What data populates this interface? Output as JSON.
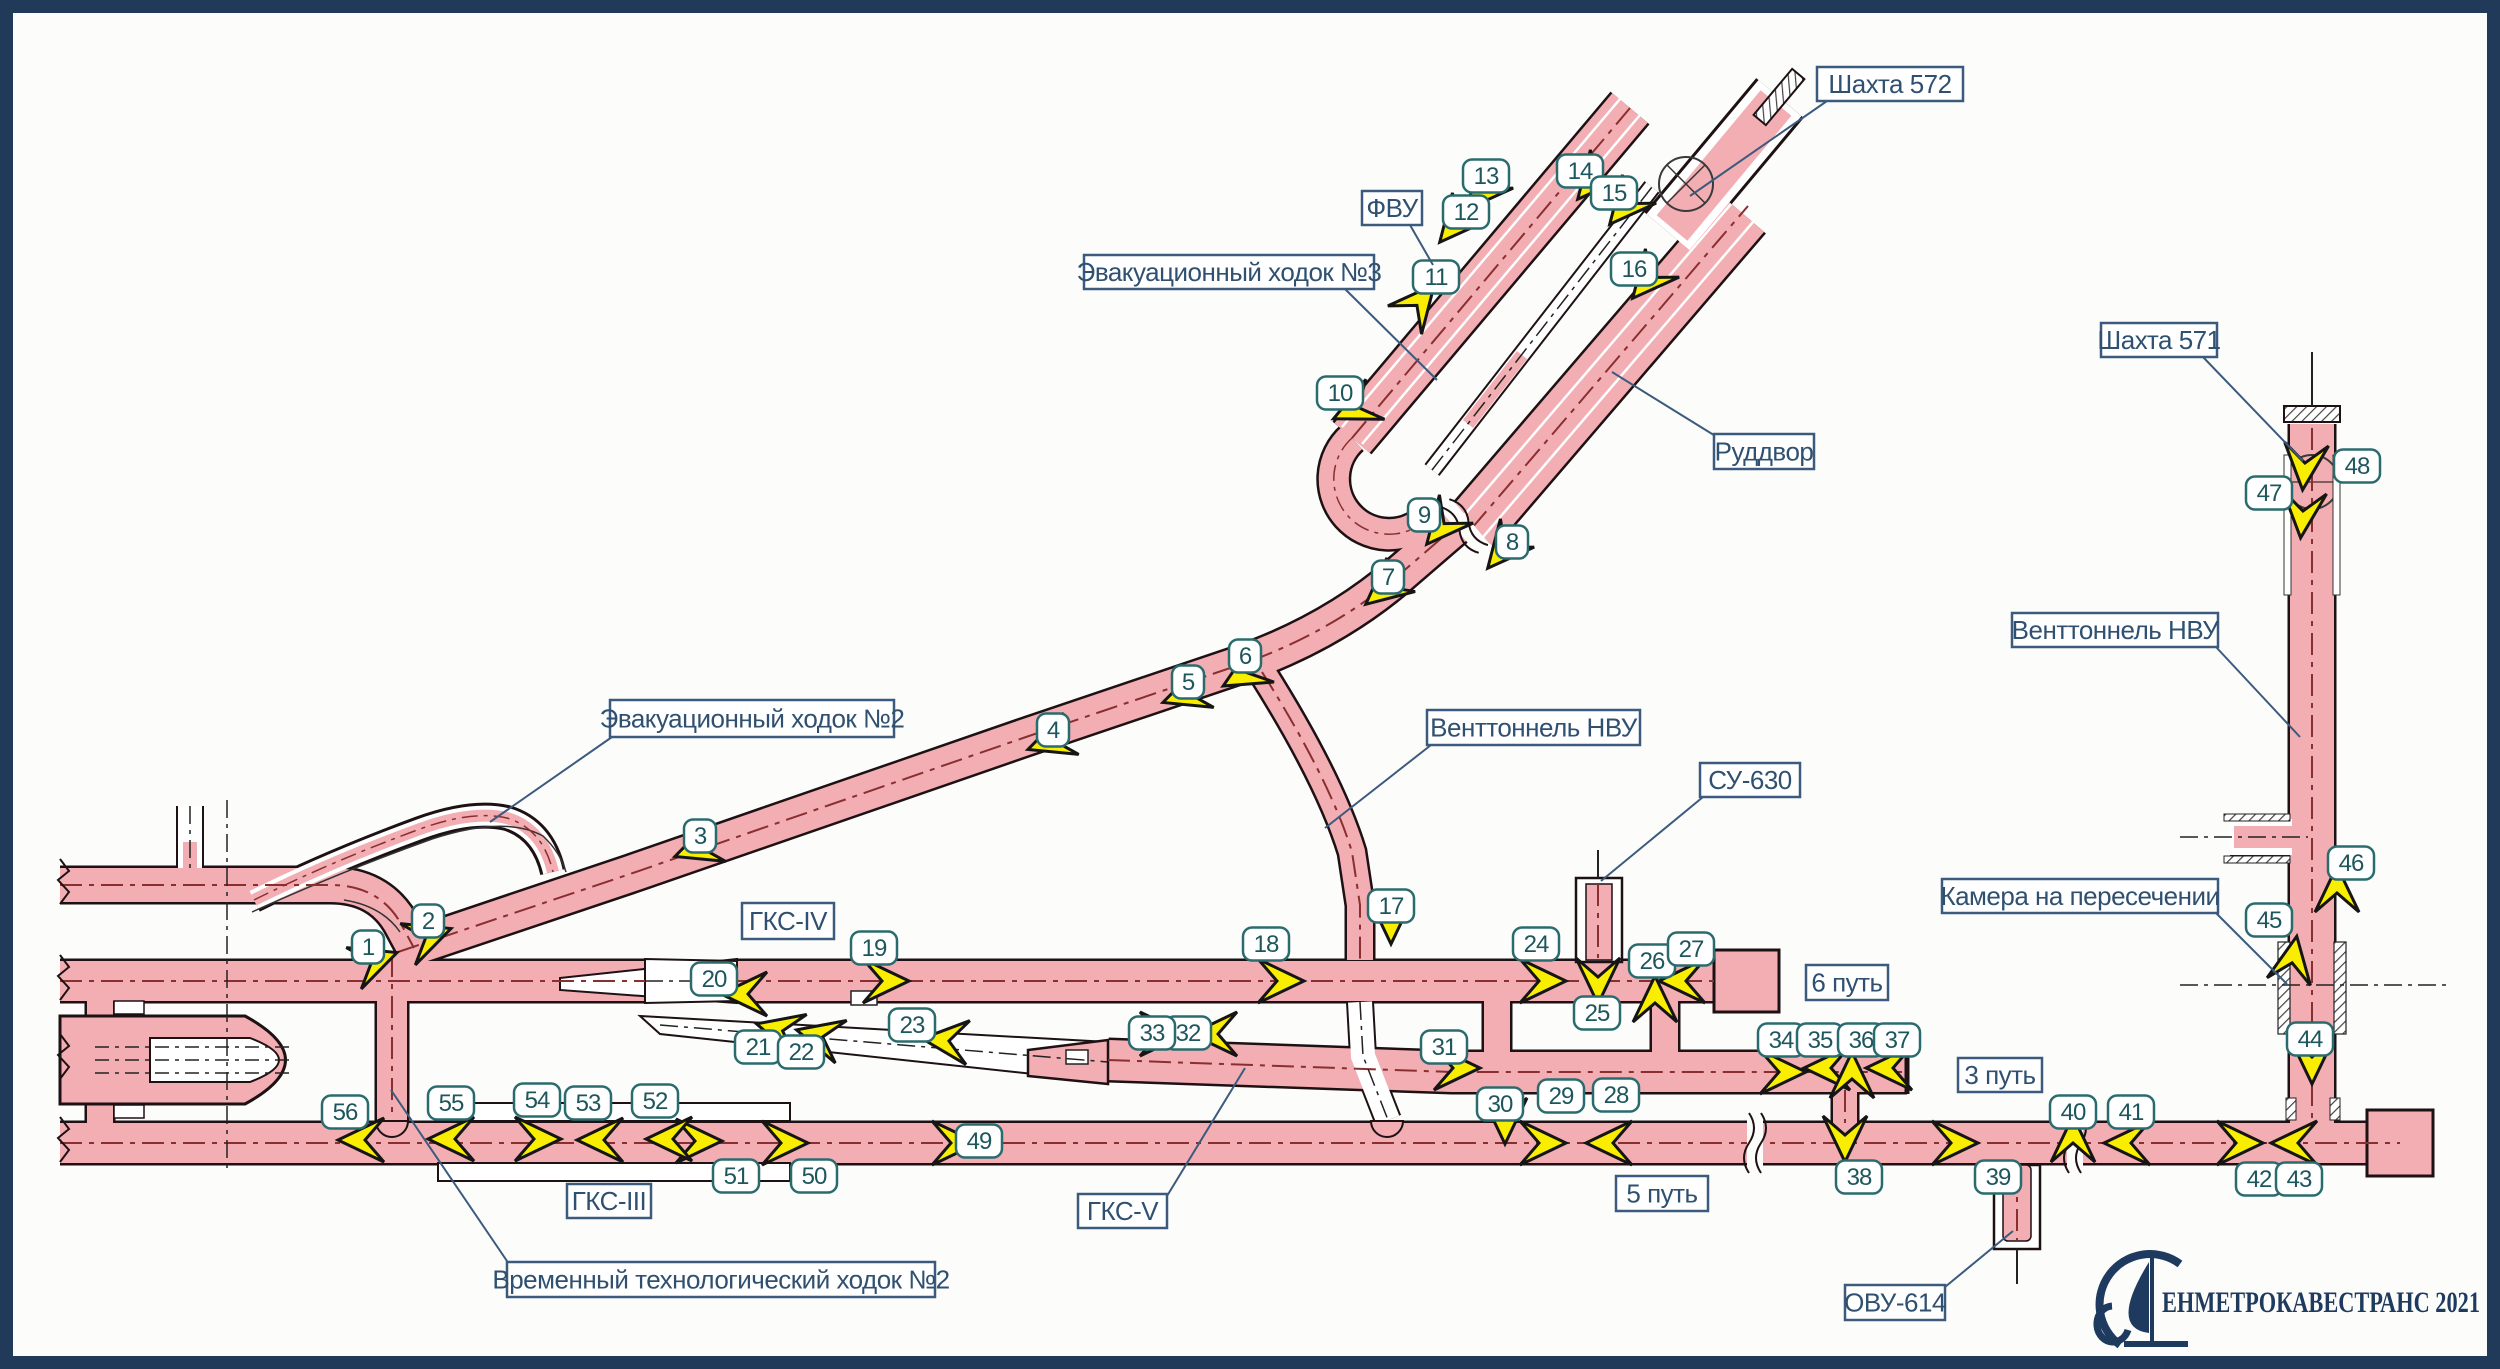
{
  "diagram": {
    "title_note": "tunnel construction scheme",
    "colors": {
      "paper": "#fcfcfb",
      "frame": "#223a5a",
      "tunnel_fill": "#f2aeb3",
      "tunnel_outline": "#1d1114",
      "tunnel_axis": "#8a2f2f",
      "unbuilt_fill": "#ffffff",
      "arrow_fill": "#f9ee00",
      "arrow_outline": "#151515",
      "marker_border": "#2a6b6e",
      "marker_text": "#1d565c",
      "label_border": "#3b5a7d",
      "label_text": "#2f5070",
      "logo": "#1e3a5e"
    },
    "labels": [
      {
        "id": "shaft-572",
        "text": "Шахта 572",
        "x": 1817,
        "y": 67,
        "w": 146,
        "h": 34,
        "leader": [
          [
            1827,
            101
          ],
          [
            1690,
            196
          ]
        ]
      },
      {
        "id": "fvu",
        "text": "ФВУ",
        "x": 1362,
        "y": 191,
        "w": 60,
        "h": 34,
        "leader": [
          [
            1410,
            225
          ],
          [
            1433,
            265
          ]
        ]
      },
      {
        "id": "evac-walk-3",
        "text": "Эвакуационный ходок №3",
        "x": 1084,
        "y": 255,
        "w": 290,
        "h": 34,
        "leader": [
          [
            1345,
            289
          ],
          [
            1437,
            380
          ]
        ]
      },
      {
        "id": "ruddvor",
        "text": "Руддвор",
        "x": 1714,
        "y": 434,
        "w": 100,
        "h": 35,
        "leader": [
          [
            1717,
            437
          ],
          [
            1612,
            372
          ]
        ]
      },
      {
        "id": "shaft-571",
        "text": "Шахта 571",
        "x": 2101,
        "y": 323,
        "w": 116,
        "h": 34,
        "leader": [
          [
            2203,
            357
          ],
          [
            2303,
            461
          ]
        ]
      },
      {
        "id": "vent-nvu-right",
        "text": "Венттоннель НВУ",
        "x": 2012,
        "y": 613,
        "w": 206,
        "h": 34,
        "leader": [
          [
            2216,
            647
          ],
          [
            2300,
            737
          ]
        ]
      },
      {
        "id": "vent-nvu-mid",
        "text": "Венттоннель НВУ",
        "x": 1427,
        "y": 710,
        "w": 213,
        "h": 35,
        "leader": [
          [
            1431,
            745
          ],
          [
            1325,
            828
          ]
        ]
      },
      {
        "id": "su-630",
        "text": "СУ-630",
        "x": 1700,
        "y": 763,
        "w": 100,
        "h": 34,
        "leader": [
          [
            1703,
            797
          ],
          [
            1601,
            881
          ]
        ]
      },
      {
        "id": "chamber",
        "text": "Камера на пересечении",
        "x": 1942,
        "y": 879,
        "w": 276,
        "h": 34,
        "leader": [
          [
            2216,
            913
          ],
          [
            2287,
            984
          ]
        ]
      },
      {
        "id": "gks-4",
        "text": "ГКС-IV",
        "x": 742,
        "y": 903,
        "w": 92,
        "h": 36,
        "leader": null
      },
      {
        "id": "track-6",
        "text": "6 путь",
        "x": 1806,
        "y": 965,
        "w": 82,
        "h": 35,
        "leader": null
      },
      {
        "id": "track-3",
        "text": "3 путь",
        "x": 1958,
        "y": 1058,
        "w": 84,
        "h": 34,
        "leader": null
      },
      {
        "id": "track-5",
        "text": "5 путь",
        "x": 1616,
        "y": 1176,
        "w": 92,
        "h": 35,
        "leader": null
      },
      {
        "id": "gks-3",
        "text": "ГКС-III",
        "x": 567,
        "y": 1184,
        "w": 84,
        "h": 34,
        "leader": null
      },
      {
        "id": "gks-5",
        "text": "ГКС-V",
        "x": 1078,
        "y": 1194,
        "w": 89,
        "h": 34,
        "leader": [
          [
            1167,
            1196
          ],
          [
            1245,
            1068
          ]
        ]
      },
      {
        "id": "ovu-614",
        "text": "ОВУ-614",
        "x": 1845,
        "y": 1285,
        "w": 100,
        "h": 35,
        "leader": [
          [
            1945,
            1287
          ],
          [
            2013,
            1231
          ]
        ]
      },
      {
        "id": "evac-walk-2",
        "text": "Эвакуационный ходок №2",
        "x": 610,
        "y": 700,
        "w": 284,
        "h": 37,
        "leader": [
          [
            612,
            737
          ],
          [
            490,
            822
          ]
        ]
      },
      {
        "id": "temp-walk-2",
        "text": "Временный технологический ходок №2",
        "x": 507,
        "y": 1262,
        "w": 428,
        "h": 35,
        "leader": [
          [
            509,
            1264
          ],
          [
            391,
            1090
          ]
        ]
      }
    ],
    "markers": [
      {
        "n": "1",
        "x": 368,
        "y": 947
      },
      {
        "n": "2",
        "x": 428,
        "y": 921
      },
      {
        "n": "3",
        "x": 700,
        "y": 836
      },
      {
        "n": "4",
        "x": 1053,
        "y": 730
      },
      {
        "n": "5",
        "x": 1188,
        "y": 682
      },
      {
        "n": "6",
        "x": 1245,
        "y": 656
      },
      {
        "n": "7",
        "x": 1388,
        "y": 577
      },
      {
        "n": "8",
        "x": 1512,
        "y": 542
      },
      {
        "n": "9",
        "x": 1424,
        "y": 515
      },
      {
        "n": "10",
        "x": 1340,
        "y": 393
      },
      {
        "n": "11",
        "x": 1436,
        "y": 277
      },
      {
        "n": "12",
        "x": 1466,
        "y": 212
      },
      {
        "n": "13",
        "x": 1486,
        "y": 176
      },
      {
        "n": "14",
        "x": 1580,
        "y": 171
      },
      {
        "n": "15",
        "x": 1614,
        "y": 193
      },
      {
        "n": "16",
        "x": 1634,
        "y": 269
      },
      {
        "n": "17",
        "x": 1391,
        "y": 906
      },
      {
        "n": "18",
        "x": 1266,
        "y": 944
      },
      {
        "n": "19",
        "x": 874,
        "y": 948
      },
      {
        "n": "20",
        "x": 714,
        "y": 979
      },
      {
        "n": "21",
        "x": 758,
        "y": 1047
      },
      {
        "n": "22",
        "x": 801,
        "y": 1052
      },
      {
        "n": "23",
        "x": 912,
        "y": 1025
      },
      {
        "n": "24",
        "x": 1536,
        "y": 944
      },
      {
        "n": "25",
        "x": 1597,
        "y": 1013
      },
      {
        "n": "26",
        "x": 1652,
        "y": 961
      },
      {
        "n": "27",
        "x": 1691,
        "y": 949
      },
      {
        "n": "28",
        "x": 1616,
        "y": 1095
      },
      {
        "n": "29",
        "x": 1561,
        "y": 1096
      },
      {
        "n": "30",
        "x": 1500,
        "y": 1104
      },
      {
        "n": "31",
        "x": 1444,
        "y": 1047
      },
      {
        "n": "32",
        "x": 1188,
        "y": 1033
      },
      {
        "n": "33",
        "x": 1152,
        "y": 1033
      },
      {
        "n": "34",
        "x": 1781,
        "y": 1040
      },
      {
        "n": "35",
        "x": 1820,
        "y": 1040
      },
      {
        "n": "36",
        "x": 1861,
        "y": 1040
      },
      {
        "n": "37",
        "x": 1897,
        "y": 1040
      },
      {
        "n": "38",
        "x": 1859,
        "y": 1177
      },
      {
        "n": "39",
        "x": 1998,
        "y": 1177
      },
      {
        "n": "40",
        "x": 2073,
        "y": 1112
      },
      {
        "n": "41",
        "x": 2131,
        "y": 1112
      },
      {
        "n": "42",
        "x": 2259,
        "y": 1179
      },
      {
        "n": "43",
        "x": 2299,
        "y": 1179
      },
      {
        "n": "44",
        "x": 2310,
        "y": 1039
      },
      {
        "n": "45",
        "x": 2269,
        "y": 920
      },
      {
        "n": "46",
        "x": 2351,
        "y": 863
      },
      {
        "n": "47",
        "x": 2269,
        "y": 493
      },
      {
        "n": "48",
        "x": 2357,
        "y": 466
      },
      {
        "n": "49",
        "x": 979,
        "y": 1141
      },
      {
        "n": "50",
        "x": 814,
        "y": 1176
      },
      {
        "n": "51",
        "x": 736,
        "y": 1176
      },
      {
        "n": "52",
        "x": 655,
        "y": 1101
      },
      {
        "n": "53",
        "x": 588,
        "y": 1103
      },
      {
        "n": "54",
        "x": 537,
        "y": 1100
      },
      {
        "n": "55",
        "x": 451,
        "y": 1103
      },
      {
        "n": "56",
        "x": 345,
        "y": 1112
      }
    ],
    "work_direction_arrows": [
      {
        "x": 382,
        "y": 958,
        "a": -20
      },
      {
        "x": 436,
        "y": 934,
        "a": -20
      },
      {
        "x": 690,
        "y": 851,
        "a": 160
      },
      {
        "x": 1043,
        "y": 744,
        "a": 160
      },
      {
        "x": 1178,
        "y": 697,
        "a": 160
      },
      {
        "x": 1237,
        "y": 678,
        "a": 150
      },
      {
        "x": 1378,
        "y": 594,
        "a": 140
      },
      {
        "x": 1498,
        "y": 556,
        "a": 130
      },
      {
        "x": 1437,
        "y": 532,
        "a": 130
      },
      {
        "x": 1348,
        "y": 412,
        "a": 155
      },
      {
        "x": 1424,
        "y": 297,
        "a": -50
      },
      {
        "x": 1450,
        "y": 230,
        "a": 130
      },
      {
        "x": 1477,
        "y": 197,
        "a": 130
      },
      {
        "x": 1588,
        "y": 187,
        "a": 130
      },
      {
        "x": 1620,
        "y": 212,
        "a": 130
      },
      {
        "x": 1643,
        "y": 286,
        "a": 130
      },
      {
        "x": 1391,
        "y": 928,
        "a": 90
      },
      {
        "x": 1288,
        "y": 981,
        "a": 0
      },
      {
        "x": 893,
        "y": 981,
        "a": 0
      },
      {
        "x": 737,
        "y": 994,
        "a": 180
      },
      {
        "x": 772,
        "y": 1028,
        "a": 195
      },
      {
        "x": 812,
        "y": 1034,
        "a": 195
      },
      {
        "x": 938,
        "y": 1040,
        "a": 185
      },
      {
        "x": 1550,
        "y": 981,
        "a": 0
      },
      {
        "x": 1598,
        "y": 988,
        "a": 90
      },
      {
        "x": 1655,
        "y": 992,
        "a": -90
      },
      {
        "x": 1675,
        "y": 981,
        "a": 180
      },
      {
        "x": 1602,
        "y": 1143,
        "a": 180
      },
      {
        "x": 1550,
        "y": 1143,
        "a": 0
      },
      {
        "x": 1505,
        "y": 1128,
        "a": 90
      },
      {
        "x": 1464,
        "y": 1068,
        "a": 0
      },
      {
        "x": 1207,
        "y": 1034,
        "a": 180
      },
      {
        "x": 1170,
        "y": 1034,
        "a": 0
      },
      {
        "x": 1790,
        "y": 1072,
        "a": 0
      },
      {
        "x": 1820,
        "y": 1068,
        "a": 180
      },
      {
        "x": 1852,
        "y": 1068,
        "a": -90
      },
      {
        "x": 1882,
        "y": 1068,
        "a": 180
      },
      {
        "x": 1845,
        "y": 1146,
        "a": 90
      },
      {
        "x": 1962,
        "y": 1143,
        "a": 0
      },
      {
        "x": 2073,
        "y": 1132,
        "a": -90
      },
      {
        "x": 2120,
        "y": 1143,
        "a": 180
      },
      {
        "x": 2247,
        "y": 1143,
        "a": 0
      },
      {
        "x": 2287,
        "y": 1143,
        "a": 180
      },
      {
        "x": 2312,
        "y": 1068,
        "a": 90
      },
      {
        "x": 2294,
        "y": 952,
        "a": -80
      },
      {
        "x": 2337,
        "y": 882,
        "a": -90
      },
      {
        "x": 2302,
        "y": 522,
        "a": 95
      },
      {
        "x": 2304,
        "y": 474,
        "a": 95
      },
      {
        "x": 962,
        "y": 1143,
        "a": 0
      },
      {
        "x": 792,
        "y": 1143,
        "a": 0
      },
      {
        "x": 706,
        "y": 1141,
        "a": 0
      },
      {
        "x": 662,
        "y": 1139,
        "a": 180
      },
      {
        "x": 593,
        "y": 1140,
        "a": 180
      },
      {
        "x": 545,
        "y": 1139,
        "a": 0
      },
      {
        "x": 444,
        "y": 1139,
        "a": 180
      },
      {
        "x": 354,
        "y": 1140,
        "a": 180
      }
    ],
    "organization_logo": {
      "emblem": "sail-emblem",
      "name": "ЕНМЕТРОКАВЕСТРАНС",
      "year": "2021"
    }
  }
}
